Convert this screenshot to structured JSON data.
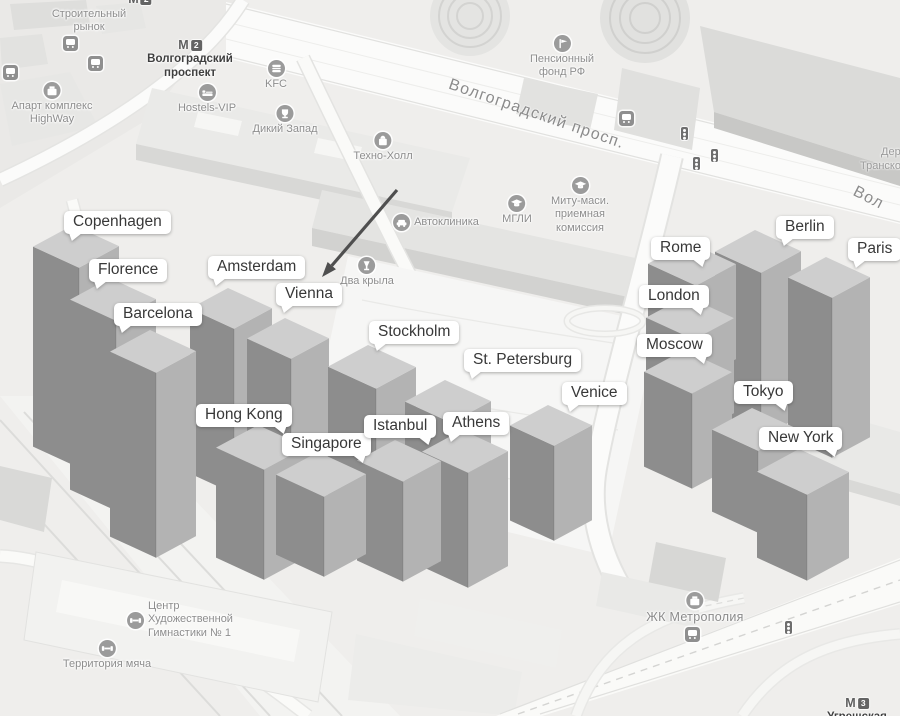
{
  "colors": {
    "bar_top": "#cecece",
    "bar_left": "#8d8d8d",
    "bar_right": "#b3b3b3",
    "bubble_bg": "#ffffff",
    "bubble_text": "#383838",
    "poi_text": "#8d8d8d",
    "metro_text": "#3f3f3f",
    "arrow": "#4f4f4f"
  },
  "annotations": {
    "arrow": {
      "from": [
        397,
        190
      ],
      "to": [
        322,
        277
      ]
    },
    "cities": [
      {
        "name": "Copenhagen",
        "x": 64,
        "y": 211,
        "tail": "left"
      },
      {
        "name": "Florence",
        "x": 89,
        "y": 259,
        "tail": "left"
      },
      {
        "name": "Barcelona",
        "x": 114,
        "y": 303,
        "tail": "left"
      },
      {
        "name": "Amsterdam",
        "x": 208,
        "y": 256,
        "tail": "left"
      },
      {
        "name": "Vienna",
        "x": 276,
        "y": 283,
        "tail": "left"
      },
      {
        "name": "Stockholm",
        "x": 369,
        "y": 321,
        "tail": "left"
      },
      {
        "name": "St. Petersburg",
        "x": 464,
        "y": 349,
        "tail": "left"
      },
      {
        "name": "Venice",
        "x": 562,
        "y": 382,
        "tail": "left"
      },
      {
        "name": "Hong Kong",
        "x": 196,
        "y": 404,
        "tail": "right"
      },
      {
        "name": "Singapore",
        "x": 282,
        "y": 433,
        "tail": "right"
      },
      {
        "name": "Istanbul",
        "x": 364,
        "y": 415,
        "tail": "right"
      },
      {
        "name": "Athens",
        "x": 443,
        "y": 412,
        "tail": "left"
      },
      {
        "name": "Rome",
        "x": 651,
        "y": 237,
        "tail": "right"
      },
      {
        "name": "London",
        "x": 639,
        "y": 285,
        "tail": "right"
      },
      {
        "name": "Moscow",
        "x": 637,
        "y": 334,
        "tail": "right"
      },
      {
        "name": "Berlin",
        "x": 776,
        "y": 216,
        "tail": "left"
      },
      {
        "name": "Paris",
        "x": 848,
        "y": 238,
        "tail": "left"
      },
      {
        "name": "Tokyo",
        "x": 734,
        "y": 381,
        "tail": "right"
      },
      {
        "name": "New York",
        "x": 759,
        "y": 427,
        "tail": "right"
      }
    ]
  },
  "bars": [
    {
      "city": "Copenhagen",
      "n": [
        73,
        225
      ],
      "w": 46,
      "d": 40,
      "h": 200
    },
    {
      "city": "Berlin",
      "n": [
        755,
        230
      ],
      "w": 46,
      "d": 40,
      "h": 165
    },
    {
      "city": "Rome",
      "n": [
        688,
        242
      ],
      "w": 48,
      "d": 40,
      "h": 95
    },
    {
      "city": "Paris",
      "n": [
        826,
        257
      ],
      "w": 44,
      "d": 38,
      "h": 160
    },
    {
      "city": "Florence",
      "n": [
        110,
        278
      ],
      "w": 46,
      "d": 40,
      "h": 190
    },
    {
      "city": "Amsterdam",
      "n": [
        228,
        288
      ],
      "w": 44,
      "d": 38,
      "h": 165
    },
    {
      "city": "London",
      "n": [
        686,
        296
      ],
      "w": 48,
      "d": 40,
      "h": 95
    },
    {
      "city": "Vienna",
      "n": [
        285,
        318
      ],
      "w": 44,
      "d": 38,
      "h": 165
    },
    {
      "city": "Barcelona",
      "n": [
        150,
        330
      ],
      "w": 46,
      "d": 40,
      "h": 185
    },
    {
      "city": "Stockholm",
      "n": [
        368,
        345
      ],
      "w": 48,
      "d": 40,
      "h": 165
    },
    {
      "city": "Moscow",
      "n": [
        684,
        350
      ],
      "w": 48,
      "d": 40,
      "h": 95
    },
    {
      "city": "St. Petersburg",
      "n": [
        445,
        380
      ],
      "w": 46,
      "d": 40,
      "h": 150
    },
    {
      "city": "Venice",
      "n": [
        548,
        405
      ],
      "w": 44,
      "d": 38,
      "h": 95
    },
    {
      "city": "Tokyo",
      "n": [
        752,
        408
      ],
      "w": 46,
      "d": 40,
      "h": 82
    },
    {
      "city": "Hong Kong",
      "n": [
        258,
        425
      ],
      "w": 48,
      "d": 42,
      "h": 110
    },
    {
      "city": "Athens",
      "n": [
        462,
        430
      ],
      "w": 46,
      "d": 40,
      "h": 115
    },
    {
      "city": "Istanbul",
      "n": [
        395,
        440
      ],
      "w": 46,
      "d": 38,
      "h": 100
    },
    {
      "city": "New York",
      "n": [
        799,
        449
      ],
      "w": 50,
      "d": 42,
      "h": 86
    },
    {
      "city": "Singapore",
      "n": [
        318,
        452
      ],
      "w": 48,
      "d": 42,
      "h": 80
    }
  ],
  "map": {
    "metro_letter": "М",
    "street_labels": [
      {
        "text": "Волгоградский просп.",
        "x": 452,
        "y": 76,
        "rotate": 19,
        "size": 16
      },
      {
        "text": "Вол",
        "x": 858,
        "y": 183,
        "rotate": 27,
        "size": 16
      }
    ],
    "edge_fragments": [
      {
        "text": "Дер",
        "x": 881,
        "y": 146
      },
      {
        "text": "Транско",
        "x": 860,
        "y": 160
      }
    ],
    "metro": [
      {
        "name": "Волгоградский\nпроспект",
        "line": "2",
        "x": 190,
        "y": 38
      },
      {
        "name": "",
        "line": "2",
        "x": 140,
        "y": -8
      },
      {
        "name": "Угрешская",
        "line": "3",
        "x": 857,
        "y": 696
      }
    ],
    "pois": [
      {
        "label": "Строительный\nрынок",
        "icon": null,
        "x": 89,
        "y": 8
      },
      {
        "label": "Апарт комплекс\nHighWay",
        "icon": "briefcase",
        "x": 52,
        "y": 82
      },
      {
        "label": "Hostels-VIP",
        "icon": "bed",
        "x": 207,
        "y": 84
      },
      {
        "label": "KFC",
        "icon": "burger",
        "x": 276,
        "y": 60
      },
      {
        "label": "Дикий Запад",
        "icon": "trophy",
        "x": 285,
        "y": 105
      },
      {
        "label": "Техно-Холл",
        "icon": "bag",
        "x": 383,
        "y": 132
      },
      {
        "label": "Пенсионный\nфонд РФ",
        "icon": "flag",
        "x": 562,
        "y": 35
      },
      {
        "label": "Автоклиника",
        "icon": "car",
        "x": 436,
        "y": 214,
        "layout": "row"
      },
      {
        "label": "МГЛИ",
        "icon": "cap",
        "x": 517,
        "y": 195
      },
      {
        "label": "Миту-маси.\nприемная\nкомиссия",
        "icon": "cap",
        "x": 580,
        "y": 177
      },
      {
        "label": "Два крыла",
        "icon": "glass",
        "x": 367,
        "y": 257
      },
      {
        "label": "Центр\nХудожественной\nГимнастики № 1",
        "icon": "dumbbell",
        "x": 180,
        "y": 600,
        "layout": "row"
      },
      {
        "label": "Территория мяча",
        "icon": "dumbbell",
        "x": 107,
        "y": 640
      },
      {
        "label": "ЖК Метрополия",
        "icon": "briefcase",
        "x": 695,
        "y": 592,
        "big": true
      }
    ],
    "transit": {
      "bus_stops": [
        [
          70,
          43
        ],
        [
          95,
          63
        ],
        [
          10,
          72
        ],
        [
          626,
          118
        ],
        [
          692,
          634
        ]
      ],
      "traffic_lights": [
        [
          684,
          133
        ],
        [
          696,
          163
        ],
        [
          714,
          155
        ],
        [
          788,
          627
        ]
      ]
    }
  }
}
